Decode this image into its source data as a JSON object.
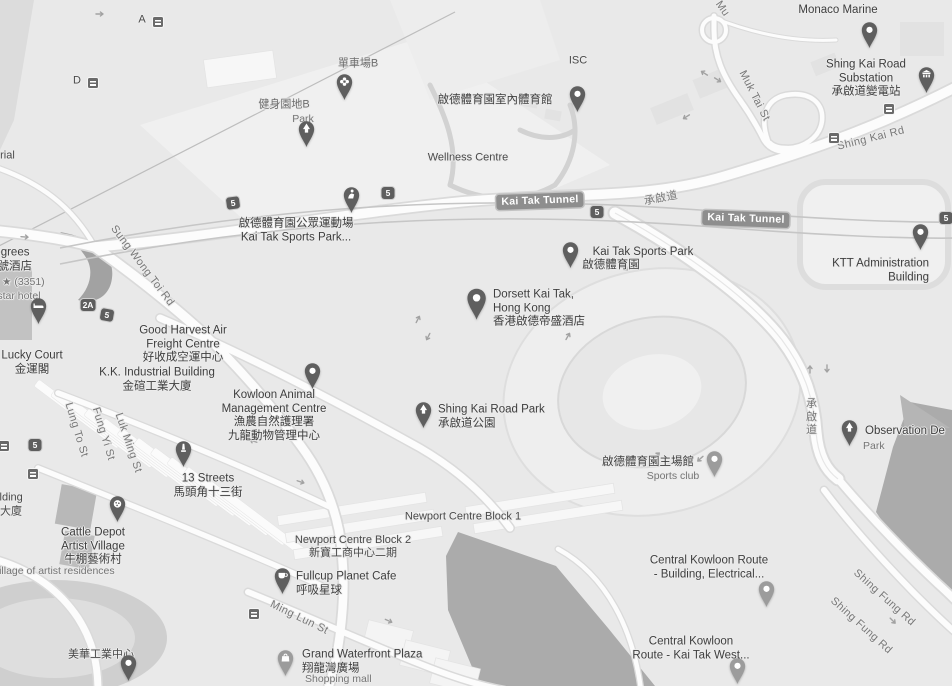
{
  "map": {
    "colors": {
      "land": "#e9e9e9",
      "water": "#ababab",
      "road_fill": "#fcfcfc",
      "road_casing": "#dadada",
      "pin_dark": "#5f5f5f",
      "pin_light": "#9c9c9c",
      "label_dark": "#3e3e3e",
      "label_gray": "#757575",
      "badge_bg": "#8e8e8e",
      "shield_bg": "#5e5e5e"
    },
    "road_badges": [
      {
        "name": "kai-tak-tunnel-1",
        "t": "Kai Tak Tunnel",
        "x": 540,
        "y": 201,
        "rot": -2
      },
      {
        "name": "kai-tak-tunnel-2",
        "t": "Kai Tak Tunnel",
        "x": 746,
        "y": 219,
        "rot": 2
      }
    ],
    "shields": [
      {
        "name": "route-5-a",
        "t": "5",
        "x": 233,
        "y": 203,
        "rot": -8
      },
      {
        "name": "route-5-b",
        "t": "5",
        "x": 388,
        "y": 193,
        "rot": 0
      },
      {
        "name": "route-5-c",
        "t": "5",
        "x": 597,
        "y": 212,
        "rot": 0
      },
      {
        "name": "route-5-d",
        "t": "5",
        "x": 946,
        "y": 218,
        "rot": 0
      },
      {
        "name": "route-5-e",
        "t": "5",
        "x": 107,
        "y": 315,
        "rot": 10
      },
      {
        "name": "route-5-f",
        "t": "5",
        "x": 35,
        "y": 445,
        "rot": 0
      },
      {
        "name": "route-2a",
        "t": "2A",
        "x": 88,
        "y": 305,
        "rot": 0
      }
    ],
    "transit_badges": [
      {
        "name": "transit-stop-a",
        "x": 833,
        "y": 137
      },
      {
        "name": "transit-stop-b",
        "x": 888,
        "y": 108
      },
      {
        "name": "transit-stop-c",
        "x": 253,
        "y": 613
      },
      {
        "name": "transit-stop-d",
        "x": 32,
        "y": 473
      },
      {
        "name": "transit-stop-e",
        "x": 3,
        "y": 445
      },
      {
        "name": "transit-stop-f",
        "x": 157,
        "y": 21
      },
      {
        "name": "transit-stop-g",
        "x": 92,
        "y": 82
      }
    ],
    "labels": [
      {
        "name": "monaco-marine",
        "cls": "poi",
        "x": 838,
        "y": 11,
        "t": "Monaco Marine"
      },
      {
        "name": "shing-kai-road-substation",
        "cls": "poi",
        "x": 866,
        "y": 79,
        "t": "Shing Kai Road\nSubstation\n承啟道變電站"
      },
      {
        "name": "cycling-area-b",
        "cls": "park",
        "x": 358,
        "y": 64,
        "t": "單車場B"
      },
      {
        "name": "fitness-area-b",
        "cls": "park",
        "x": 284,
        "y": 105,
        "t": "健身園地B"
      },
      {
        "name": "fitness-area-b-cat",
        "cls": "cat",
        "x": 303,
        "y": 119,
        "t": "Park"
      },
      {
        "name": "indoor-sports-centre",
        "cls": "poi",
        "x": 495,
        "y": 101,
        "t": "啟德體育園室內體育館"
      },
      {
        "name": "isc",
        "cls": "area",
        "x": 578,
        "y": 61,
        "t": "ISC"
      },
      {
        "name": "wellness-centre",
        "cls": "area",
        "x": 468,
        "y": 158,
        "t": "Wellness Centre"
      },
      {
        "name": "public-sports-ground",
        "cls": "poi",
        "x": 296,
        "y": 231,
        "t": "啟德體育園公眾運動場\nKai Tak Sports Park..."
      },
      {
        "name": "kai-tak-sports-park",
        "cls": "poi",
        "x": 643,
        "y": 253,
        "t": "Kai Tak Sports Park"
      },
      {
        "name": "kai-tak-sports-park-zh",
        "cls": "poi",
        "x": 611,
        "y": 266,
        "t": "啟德體育園"
      },
      {
        "name": "dorsett-kai-tak",
        "cls": "poi",
        "anchor": "w",
        "x": 493,
        "y": 309,
        "t": "Dorsett Kai Tak,\nHong Kong\n香港啟德帝盛酒店"
      },
      {
        "name": "ktt-administration",
        "cls": "poi",
        "anchor": "e",
        "x": 929,
        "y": 271,
        "t": "KTT Administration\nBuilding"
      },
      {
        "name": "shing-kai-road-park",
        "cls": "poi",
        "anchor": "w",
        "x": 438,
        "y": 417,
        "t": "Shing Kai Road Park\n承啟道公園"
      },
      {
        "name": "kowloon-animal-centre",
        "cls": "poi",
        "x": 274,
        "y": 416,
        "t": "Kowloon Animal\nManagement Centre\n漁農自然護理署\n九龍動物管理中心"
      },
      {
        "name": "good-harvest",
        "cls": "poi",
        "x": 183,
        "y": 345,
        "t": "Good Harvest Air\nFreight Centre\n好收成空運中心"
      },
      {
        "name": "kk-industrial",
        "cls": "poi",
        "x": 157,
        "y": 380,
        "t": "K.K. Industrial Building\n金碹工業大廈"
      },
      {
        "name": "lucky-court",
        "cls": "poi",
        "x": 32,
        "y": 363,
        "t": "Lucky Court\n金運閣"
      },
      {
        "name": "degrees-hotel",
        "cls": "poi",
        "anchor": "w",
        "x": -14,
        "y": 260,
        "t": "Degrees\n壹號酒店"
      },
      {
        "name": "degrees-rating",
        "cls": "cat",
        "anchor": "w",
        "x": 2,
        "y": 282,
        "t": "★ (3351)"
      },
      {
        "name": "degrees-cat",
        "cls": "cat",
        "anchor": "w",
        "x": -12,
        "y": 296,
        "t": "4-star hotel"
      },
      {
        "name": "left-building",
        "cls": "area",
        "anchor": "w",
        "x": -28,
        "y": 498,
        "t": "al Building"
      },
      {
        "name": "left-building-zh",
        "cls": "area",
        "anchor": "w",
        "x": 0,
        "y": 512,
        "t": "大廈"
      },
      {
        "name": "memorial",
        "cls": "area",
        "anchor": "w",
        "x": -6,
        "y": 156,
        "t": "orial"
      },
      {
        "name": "cattle-depot",
        "cls": "poi",
        "x": 93,
        "y": 547,
        "t": "Cattle Depot\nArtist Village\n牛棚藝術村"
      },
      {
        "name": "artist-residences",
        "cls": "cat",
        "anchor": "w",
        "x": -12,
        "y": 571,
        "t": "t village of artist residences"
      },
      {
        "name": "mei-wah-industrial",
        "cls": "area",
        "x": 101,
        "y": 655,
        "t": "美華工業中心"
      },
      {
        "name": "thirteen-streets",
        "cls": "poi",
        "x": 208,
        "y": 486,
        "t": "13 Streets\n馬頭角十三街"
      },
      {
        "name": "newport-block-1",
        "cls": "area",
        "x": 463,
        "y": 517,
        "t": "Newport Centre Block 1"
      },
      {
        "name": "newport-block-2",
        "cls": "area",
        "x": 353,
        "y": 547,
        "t": "Newport Centre Block 2\n新寶工商中心二期"
      },
      {
        "name": "fullcup-planet-cafe",
        "cls": "poi",
        "anchor": "w",
        "x": 296,
        "y": 584,
        "t": "Fullcup Planet Cafe\n呼吸星球"
      },
      {
        "name": "grand-waterfront-plaza",
        "cls": "poi",
        "anchor": "w",
        "x": 302,
        "y": 662,
        "t": "Grand Waterfront Plaza\n翔龍灣廣場"
      },
      {
        "name": "grand-waterfront-cat",
        "cls": "cat",
        "anchor": "w",
        "x": 305,
        "y": 679,
        "t": "Shopping mall"
      },
      {
        "name": "main-stadium",
        "cls": "poi",
        "x": 648,
        "y": 463,
        "t": "啟德體育園主場館"
      },
      {
        "name": "main-stadium-cat",
        "cls": "cat",
        "x": 673,
        "y": 476,
        "t": "Sports club"
      },
      {
        "name": "ckr-building",
        "cls": "poi",
        "x": 709,
        "y": 568,
        "t": "Central Kowloon Route\n- Building, Electrical..."
      },
      {
        "name": "ckr-kai-tak-west",
        "cls": "poi",
        "x": 691,
        "y": 649,
        "t": "Central Kowloon\nRoute - Kai Tak West..."
      },
      {
        "name": "observation-deck",
        "cls": "poi",
        "anchor": "w",
        "x": 865,
        "y": 432,
        "t": "Observation De"
      },
      {
        "name": "observation-deck-cat",
        "cls": "cat",
        "anchor": "w",
        "x": 863,
        "y": 446,
        "t": "Park"
      },
      {
        "name": "sung-wong-toi-rd",
        "cls": "road",
        "x": 142,
        "y": 266,
        "rot": 53,
        "t": "Sung Wong Toi Rd"
      },
      {
        "name": "muk-tai-st",
        "cls": "road",
        "x": 754,
        "y": 96,
        "rot": 63,
        "t": "Muk Tai St"
      },
      {
        "name": "muk-tai-st-top",
        "cls": "road",
        "x": 722,
        "y": 9,
        "rot": 55,
        "t": "Mu"
      },
      {
        "name": "shing-kai-rd",
        "cls": "road",
        "x": 871,
        "y": 139,
        "rot": -14,
        "t": "Shing Kai Rd"
      },
      {
        "name": "shing-kai-do",
        "cls": "road",
        "x": 661,
        "y": 199,
        "rot": -11,
        "t": "承啟道"
      },
      {
        "name": "shing-kai-do-vertical",
        "cls": "road",
        "x": 810,
        "y": 417,
        "vert": true,
        "t": "承啟道"
      },
      {
        "name": "ming-lun-st",
        "cls": "road",
        "x": 299,
        "y": 618,
        "rot": 26,
        "t": "Ming Lun St"
      },
      {
        "name": "lung-to-st",
        "cls": "road",
        "x": 76,
        "y": 430,
        "rot": 73,
        "t": "Lung To St"
      },
      {
        "name": "fung-yi-st",
        "cls": "road",
        "x": 103,
        "y": 434,
        "rot": 73,
        "t": "Fung Yi St"
      },
      {
        "name": "luk-ming-st",
        "cls": "road",
        "x": 128,
        "y": 443,
        "rot": 71,
        "t": "Luk Ming St"
      },
      {
        "name": "shing-fung-rd-1",
        "cls": "road",
        "x": 884,
        "y": 598,
        "rot": 42,
        "t": "Shing Fung Rd"
      },
      {
        "name": "shing-fung-rd-2",
        "cls": "road",
        "x": 861,
        "y": 626,
        "rot": 42,
        "t": "Shing Fung Rd"
      },
      {
        "name": "stop-a",
        "cls": "area",
        "x": 142,
        "y": 20,
        "t": "A"
      },
      {
        "name": "stop-d",
        "cls": "area",
        "x": 77,
        "y": 81,
        "t": "D"
      }
    ],
    "pins": [
      {
        "name": "monaco-marine-pin",
        "type": "dot",
        "shade": "dark",
        "x": 869,
        "y": 48
      },
      {
        "name": "substation-pin",
        "type": "bank",
        "shade": "dark",
        "x": 926,
        "y": 93
      },
      {
        "name": "cycling-area-pin",
        "type": "flower",
        "shade": "dark",
        "x": 344,
        "y": 100
      },
      {
        "name": "fitness-park-pin",
        "type": "tree",
        "shade": "dark",
        "x": 306,
        "y": 147
      },
      {
        "name": "indoor-sports-pin",
        "type": "dot",
        "shade": "dark",
        "x": 577,
        "y": 112
      },
      {
        "name": "sports-ground-pin",
        "type": "stadium",
        "shade": "dark",
        "x": 351,
        "y": 213
      },
      {
        "name": "sports-park-pin",
        "type": "dot",
        "shade": "dark",
        "x": 570,
        "y": 268
      },
      {
        "name": "dorsett-pin",
        "type": "dot",
        "shade": "dark",
        "x": 477,
        "y": 320,
        "scale": 1.2
      },
      {
        "name": "animal-centre-pin",
        "type": "dot",
        "shade": "dark",
        "x": 312,
        "y": 389
      },
      {
        "name": "shing-kai-road-park-pin",
        "type": "tree",
        "shade": "dark",
        "x": 423,
        "y": 428
      },
      {
        "name": "main-stadium-pin",
        "type": "dot",
        "shade": "light",
        "x": 714,
        "y": 477
      },
      {
        "name": "observation-deck-pin",
        "type": "tree",
        "shade": "dark",
        "x": 849,
        "y": 446
      },
      {
        "name": "thirteen-streets-pin",
        "type": "monument",
        "shade": "dark",
        "x": 183,
        "y": 467
      },
      {
        "name": "cattle-depot-pin",
        "type": "palette",
        "shade": "dark",
        "x": 117,
        "y": 522
      },
      {
        "name": "fullcup-cafe-pin",
        "type": "cafe",
        "shade": "dark",
        "x": 282,
        "y": 594
      },
      {
        "name": "grand-waterfront-pin",
        "type": "shopping",
        "shade": "light",
        "x": 285,
        "y": 676
      },
      {
        "name": "mei-wah-pin",
        "type": "dot",
        "shade": "dark",
        "x": 128,
        "y": 681
      },
      {
        "name": "ckr-building-pin",
        "type": "dot",
        "shade": "light",
        "x": 766,
        "y": 607
      },
      {
        "name": "ckr-west-pin",
        "type": "dot",
        "shade": "light",
        "x": 737,
        "y": 684
      },
      {
        "name": "ktt-admin-pin",
        "type": "dot",
        "shade": "dark",
        "x": 920,
        "y": 250
      },
      {
        "name": "degrees-hotel-pin",
        "type": "bed",
        "shade": "dark",
        "x": 38,
        "y": 324
      }
    ]
  }
}
